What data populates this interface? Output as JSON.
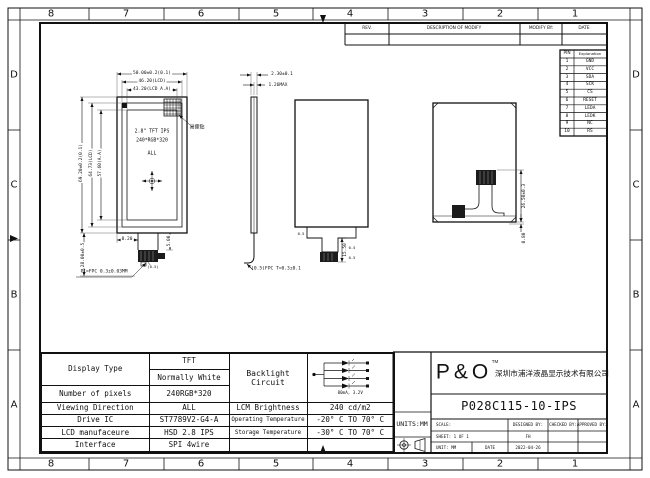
{
  "zones": {
    "top": [
      "8",
      "7",
      "6",
      "5",
      "4",
      "3",
      "2",
      "1"
    ],
    "bottom": [
      "8",
      "7",
      "6",
      "5",
      "4",
      "3",
      "2",
      "1"
    ],
    "left": [
      "D",
      "C",
      "B",
      "A"
    ],
    "right": [
      "D",
      "C",
      "B",
      "A"
    ]
  },
  "rev_table": {
    "rev": "REV.",
    "description": "DESCRIPTION OF MODIFY",
    "modify_by": "MODIFY BY:",
    "date": "DATE"
  },
  "pin_table": {
    "pin_header": "PIN",
    "explanation_header": "Explanation",
    "rows": [
      [
        "1",
        "GND"
      ],
      [
        "2",
        "VCC"
      ],
      [
        "3",
        "SDA"
      ],
      [
        "4",
        "SCK"
      ],
      [
        "5",
        "CS"
      ],
      [
        "6",
        "RESET"
      ],
      [
        "7",
        "LEDA"
      ],
      [
        "8",
        "LEDK"
      ],
      [
        "9",
        "NC"
      ],
      [
        "10",
        "RS"
      ]
    ]
  },
  "front_view": {
    "dim_width_outer": "50.00±0.2(0.1)",
    "dim_width_lcd": "46.20(LCD)",
    "dim_width_aa": "43.20(LCD A.A)",
    "dim_height_outer": "69.20±0.2(0.1)",
    "dim_height_lcd": "64.73(LCD)",
    "dim_height_aa": "57.60(A.A)",
    "dim_fpc_length": "28.00±0.5",
    "dim_fpc_offset": "8.20",
    "dim_connector_h": "5.00",
    "dim_pitch": "(0.5)",
    "screen_line1": "2.8\" TFT IPS",
    "screen_line2": "240*RGB*320",
    "screen_line3": "ALL",
    "sticker_label": "易撕贴",
    "fpc_note": "P1=FPC 0.3±0.03MM"
  },
  "side_view": {
    "dim_total_thickness": "2.30±0.1",
    "dim_panel_thickness": "1.26MAX",
    "fpc_note": "(0.5)FPC T=0.3±0.1"
  },
  "outline_view": {
    "dim_tail": "15.50",
    "dim_a": "0.5",
    "dim_b": "0.5",
    "dim_c": "0.5"
  },
  "back_view": {
    "dim_connector": "26.50±0.3",
    "dim_edge": "0.80"
  },
  "spec_table": {
    "rows": [
      {
        "label": "Display Type",
        "value": "TFT"
      },
      {
        "label": "",
        "value": "Normally White"
      },
      {
        "label": "Number of pixels",
        "value": "240RGB*320"
      },
      {
        "label": "Viewing Direction",
        "value": "ALL",
        "label2": "LCM Brightness",
        "value2": "240 cd/m2"
      },
      {
        "label": "Drive IC",
        "value": "ST7789V2-G4-A",
        "label2": "Operating Temperature",
        "value2": "-20° C TO 70° C"
      },
      {
        "label": "LCD manufaceure",
        "value": "HSD 2.8 IPS",
        "label2": "Storage Temperature",
        "value2": "-30° C TO 70° C"
      },
      {
        "label": "Interface",
        "value": "SPI 4wire",
        "label2": "",
        "value2": ""
      }
    ],
    "backlight_label": "Backlight Circuit",
    "backlight_rating": "80mA, 3.2V"
  },
  "title_block": {
    "logo": "P&O",
    "logo_tm": "TM",
    "company": "深圳市浦洋液晶显示技术有限公司",
    "part_number": "P028C115-10-IPS",
    "units": "UNITS:MM",
    "scale_label": "SCALE:",
    "designed_label": "DESIGNED BY:",
    "checked_label": "CHECKED BY:",
    "approved_label": "APPROVED BY:",
    "sheet_label": "SHEET:  1  OF  1",
    "designer": "FH",
    "unit_label": "UNIT:  MM",
    "date_label": "DATE",
    "date_value": "2022-04-26"
  }
}
